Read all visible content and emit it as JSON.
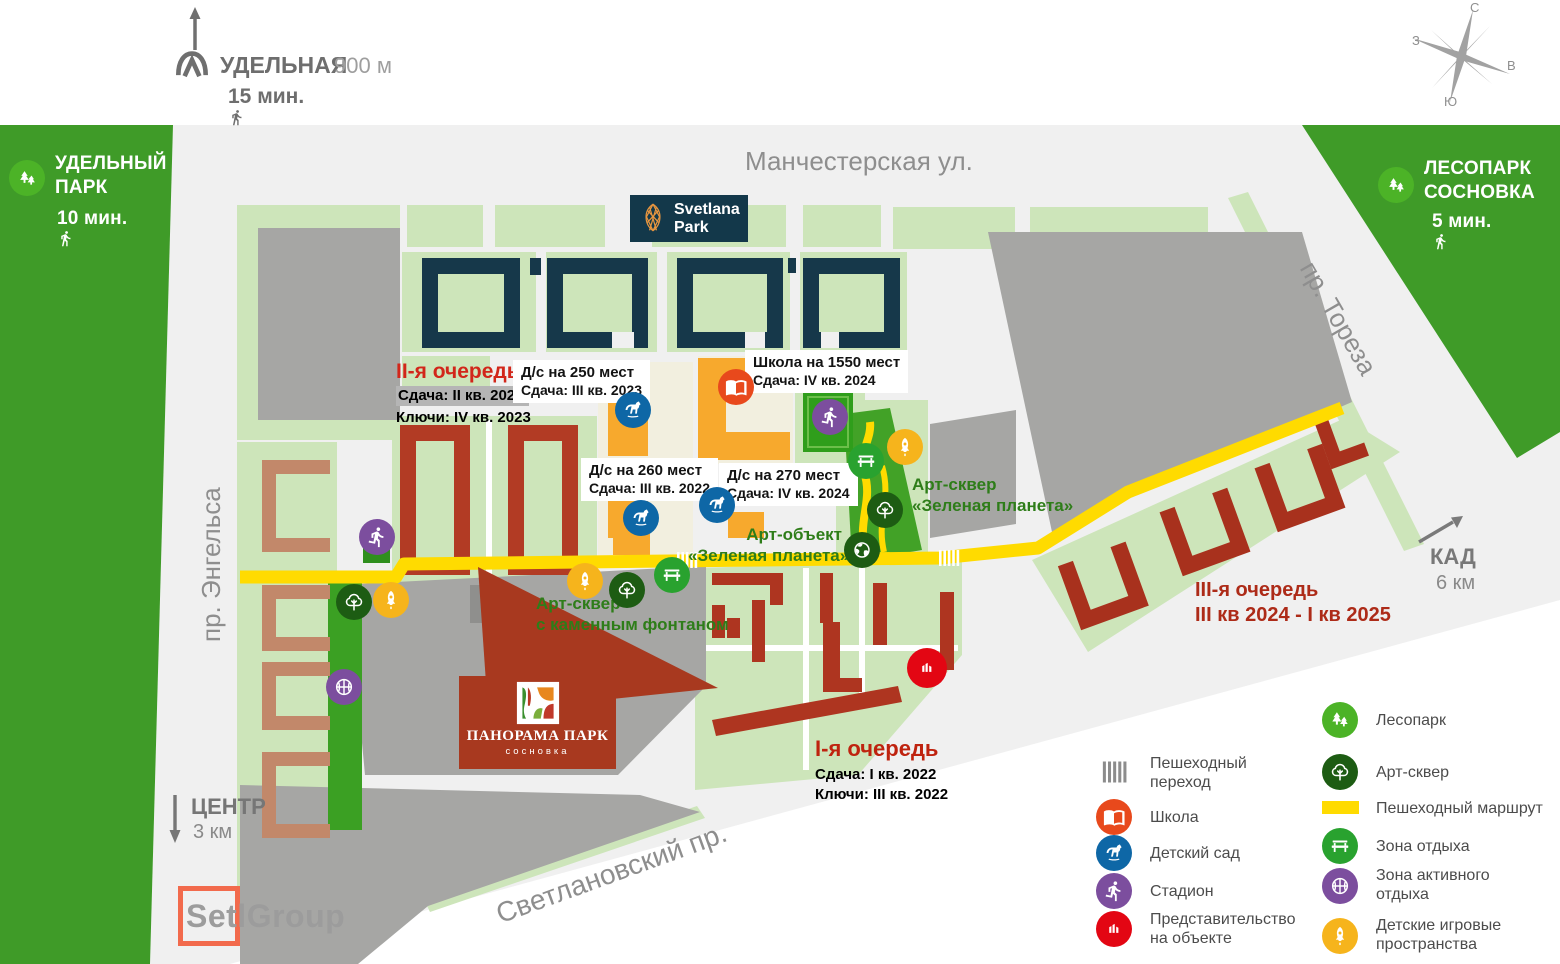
{
  "brand": {
    "developer_logo": "SetlGroup",
    "project_name": "ПАНОРАМА ПАРК",
    "project_subname": "сосновка",
    "neighbor_project": {
      "line1": "Svetlana",
      "line2": "Park"
    }
  },
  "transit": {
    "metro": {
      "name": "УДЕЛЬНАЯ",
      "distance": "900 м",
      "walk_time": "15 мин."
    },
    "center": {
      "name": "ЦЕНТР",
      "distance": "3 км"
    },
    "kad": {
      "name": "КАД",
      "distance": "6 км"
    }
  },
  "parks": {
    "udelny": {
      "line1": "УДЕЛЬНЫЙ",
      "line2": "ПАРК",
      "walk_time": "10 мин."
    },
    "sosnovka": {
      "line1": "ЛЕСОПАРК",
      "line2": "СОСНОВКА",
      "walk_time": "5 мин."
    }
  },
  "streets": {
    "north": "Манчестерская ул.",
    "west": "пр. Энгельса",
    "east": "пр. Тореза",
    "south": "Светлановский пр."
  },
  "compass": {
    "north": "С",
    "east": "В",
    "south": "Ю",
    "west": "З"
  },
  "phases": {
    "first": {
      "title": "I-я очередь",
      "delivery": "Сдача: I кв. 2022",
      "keys": "Ключи: III кв. 2022"
    },
    "second": {
      "title": "II-я очередь",
      "delivery": "Сдача: II кв. 2023",
      "keys": "Ключи: IV кв. 2023"
    },
    "third": {
      "title": "III-я очередь",
      "dates": "III кв 2024 - I кв 2025"
    }
  },
  "facilities": {
    "kindergarten_250": {
      "name": "Д/с на 250 мест",
      "delivery": "Сдача: III кв. 2023"
    },
    "school_1550": {
      "name": "Школа на 1550 мест",
      "delivery": "Сдача: IV кв. 2024"
    },
    "kindergarten_260": {
      "name": "Д/с на 260 мест",
      "delivery": "Сдача: III кв. 2022"
    },
    "kindergarten_270": {
      "name": "Д/с на 270 мест",
      "delivery": "Сдача: IV кв. 2024"
    }
  },
  "art_objects": {
    "green_planet_square": {
      "line1": "Арт-сквер",
      "line2": "«Зеленая планета»"
    },
    "green_planet_object": {
      "line1": "Арт-объект",
      "line2": "«Зеленая планета»"
    },
    "stone_fountain_square": {
      "line1": "Арт-сквер",
      "line2": "с каменным фонтаном"
    }
  },
  "legend": {
    "crossing": {
      "icon": "crossing-icon",
      "label": "Пешеходный переход"
    },
    "school": {
      "icon": "school-icon",
      "label": "Школа"
    },
    "kindergarten": {
      "icon": "kindergarten-icon",
      "label": "Детский сад"
    },
    "stadium": {
      "icon": "stadium-icon",
      "label": "Стадион"
    },
    "representative": {
      "icon": "representative-icon",
      "label": "Представительство на объекте"
    },
    "forest_park": {
      "icon": "forest-park-icon",
      "label": "Лесопарк"
    },
    "art_square": {
      "icon": "art-square-icon",
      "label": "Арт-сквер"
    },
    "walking_route": {
      "icon": "walking-route-icon",
      "label": "Пешеходный маршрут"
    },
    "rest_zone": {
      "icon": "rest-zone-icon",
      "label": "Зона отдыха"
    },
    "active_rest_zone": {
      "icon": "active-rest-icon",
      "label": "Зона активного отдыха"
    },
    "kids_play_spaces": {
      "icon": "kids-play-icon",
      "label": "Детские игровые пространства"
    }
  },
  "map_markers": [
    "stadium",
    "stadium",
    "kindergarten",
    "kindergarten",
    "kindergarten",
    "school",
    "rest-zone",
    "rest-zone",
    "kids-play",
    "kids-play",
    "kids-play",
    "art-square",
    "art-square",
    "art-square",
    "art-object-earth",
    "active-rest",
    "representative"
  ],
  "colors": {
    "road": "#f0f0f0",
    "park_green": "#3f9b28",
    "block_green": "#cde5ba",
    "strip_green": "#3ba023",
    "navy": "#16384a",
    "phase_red": "#b23b24",
    "existing_salmon": "#c2886a",
    "social_orange": "#f7a92d",
    "route_yellow": "#ffdb00",
    "school_red": "#e8491c",
    "kindergarten_blue": "#0e67a6",
    "stadium_purple": "#7c4e9e",
    "rep_red": "#e30613",
    "art_dark_green": "#1d5c13",
    "rest_green": "#29a22f",
    "kids_amber": "#f6b41c",
    "callout_red": "#a8391f"
  }
}
